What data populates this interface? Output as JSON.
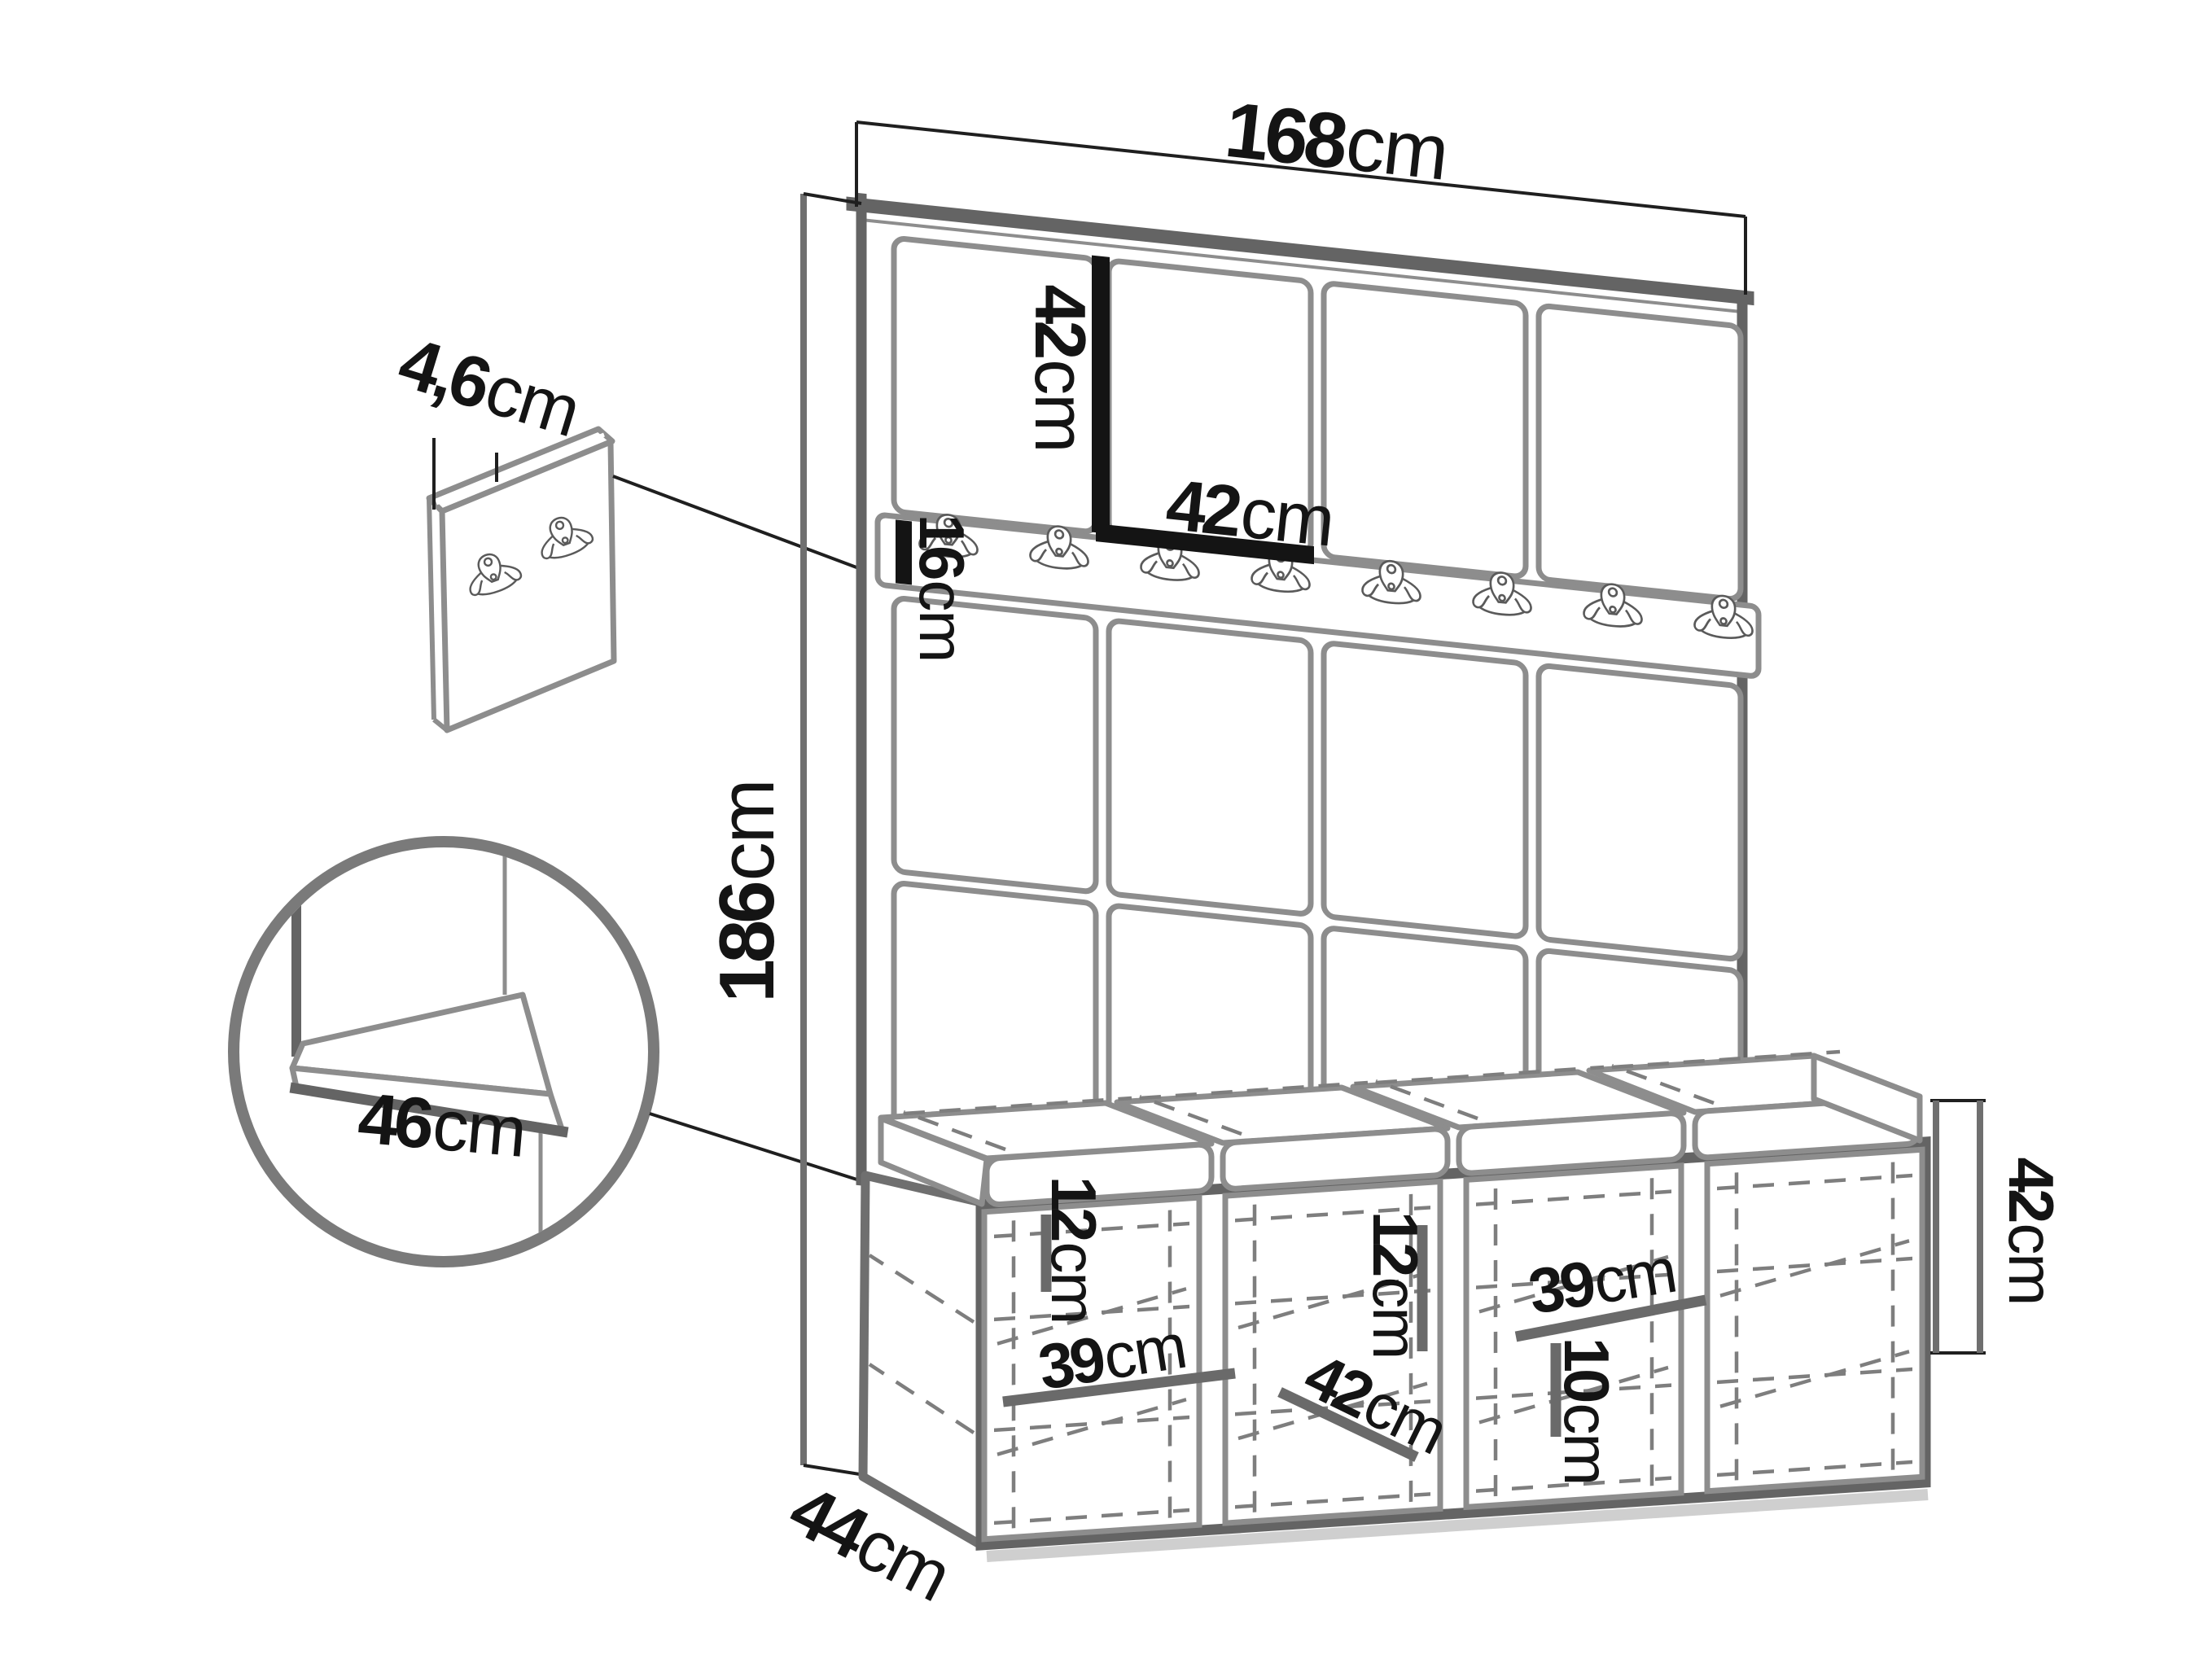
{
  "diagram": {
    "title": "Hallway wall-panel and bench set dimensional drawing",
    "background": "#ffffff",
    "colors": {
      "furniture_edge_dark": "#646464",
      "furniture_edge_mid": "#8d8d8d",
      "hidden_dashed_line": "#7e7e7e",
      "dimension_line": "#1f1f1f",
      "dimension_line_gray": "#6f6f6f",
      "label_text": "#141414"
    },
    "labels": {
      "total_width": {
        "value": "168",
        "unit": "cm"
      },
      "panel_height": {
        "value": "42",
        "unit": "cm"
      },
      "panel_width": {
        "value": "42",
        "unit": "cm"
      },
      "rail_height": {
        "value": "16",
        "unit": "cm"
      },
      "total_height": {
        "value": "186",
        "unit": "cm"
      },
      "panel_thickness": {
        "value": "4,6",
        "unit": "cm"
      },
      "seat_depth": {
        "value": "46",
        "unit": "cm"
      },
      "unit_depth": {
        "value": "44",
        "unit": "cm"
      },
      "left_shelf_gap": {
        "value": "12",
        "unit": "cm"
      },
      "left_cubby_width": {
        "value": "39",
        "unit": "cm"
      },
      "mid_shelf_gap": {
        "value": "12",
        "unit": "cm"
      },
      "mid_module_width": {
        "value": "42",
        "unit": "cm"
      },
      "right_cubby_width": {
        "value": "39",
        "unit": "cm"
      },
      "right_shelf_gap": {
        "value": "10",
        "unit": "cm"
      },
      "bench_height": {
        "value": "42",
        "unit": "cm"
      }
    },
    "counts": {
      "wall_panel_columns": 4,
      "wall_panel_rows": 3,
      "rail_hooks": 8,
      "detail_panel_hooks": 2,
      "bench_modules": 4,
      "seat_cushions": 4
    }
  }
}
